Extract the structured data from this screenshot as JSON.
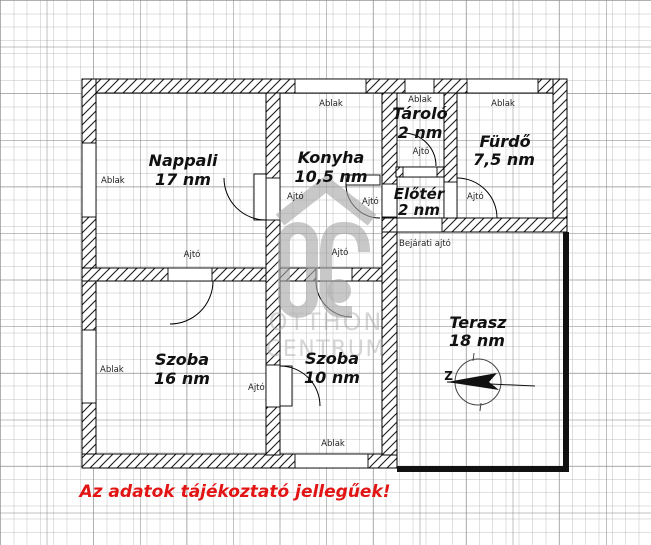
{
  "floorplan": {
    "rooms": [
      {
        "id": "nappali",
        "name": "Nappali",
        "area": "17 nm"
      },
      {
        "id": "konyha",
        "name": "Konyha",
        "area": "10,5 nm"
      },
      {
        "id": "tarolo",
        "name": "Tároló",
        "area": "2 nm"
      },
      {
        "id": "furdo",
        "name": "Fürdő",
        "area": "7,5 nm"
      },
      {
        "id": "eloter",
        "name": "Előtér",
        "area": "2 nm"
      },
      {
        "id": "szoba16",
        "name": "Szoba",
        "area": "16 nm"
      },
      {
        "id": "szoba10",
        "name": "Szoba",
        "area": "10 nm"
      },
      {
        "id": "terasz",
        "name": "Terasz",
        "area": "18 nm"
      }
    ],
    "labels": {
      "window": "Ablak",
      "door": "Ajtó",
      "entrance": "Bejárati ajtó",
      "compass": "Z"
    },
    "watermark": {
      "word1": "OTTHON",
      "word2": "CENTRUM"
    },
    "disclaimer": "Az adatok tájékoztató jellegűek!",
    "colors": {
      "wall_line": "#000000",
      "grid_minor": "#e3e3e3",
      "grid_major": "#ababab",
      "disclaimer_red": "#e21414",
      "watermark_gray": "#a8a8a8",
      "terrace_border": "#111111"
    }
  }
}
